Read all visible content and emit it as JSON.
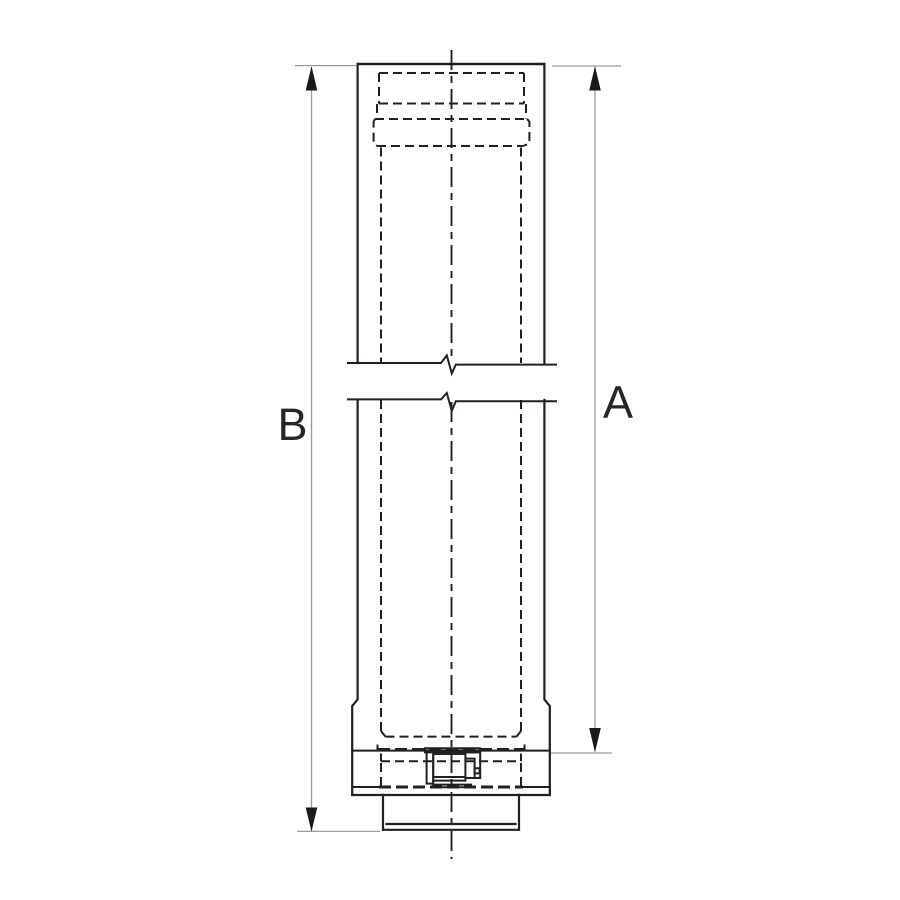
{
  "drawing": {
    "labels": {
      "a": "A",
      "b": "B"
    },
    "colors": {
      "ink": "#231f20",
      "dim_line": "#9b9b9b",
      "arrow": "#1a1a1a",
      "background": "#ffffff",
      "label_text": "#262626"
    }
  }
}
